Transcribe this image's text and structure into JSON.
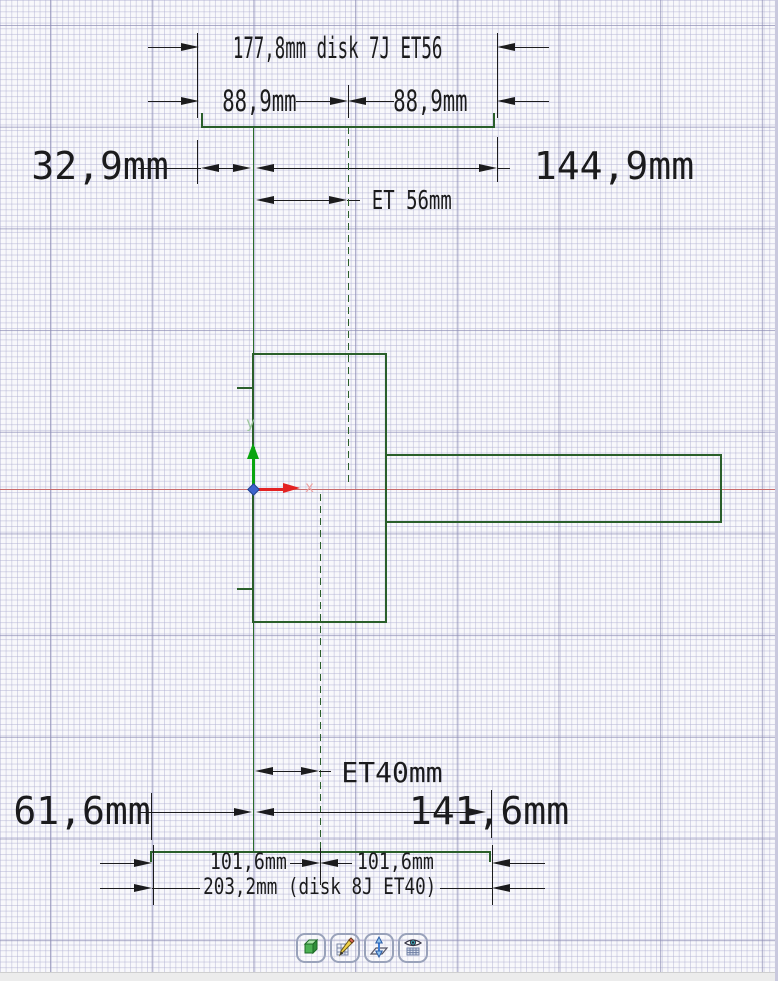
{
  "app": {
    "name": "CAD wheel drawing canvas"
  },
  "dimensions": {
    "top_disk": {
      "width": "177,8mm disk 7J ET56",
      "half_left": "88,9mm",
      "half_right": "88,9mm",
      "back_space": "32,9mm",
      "front_space": "144,9mm",
      "offset": "ET 56mm"
    },
    "bottom_disk": {
      "offset": "ET40mm",
      "back_space": "61,6mm",
      "front_space": "141,6mm",
      "half_left": "101,6mm",
      "half_right": "101,6mm",
      "width": "203,2mm (disk 8J ET40)"
    }
  },
  "axes": {
    "x": "x",
    "y": "y"
  },
  "toolbar": {
    "buttons": [
      {
        "icon": "cube-icon"
      },
      {
        "icon": "sketch-pencil-icon"
      },
      {
        "icon": "plane-normal-icon"
      },
      {
        "icon": "eye-table-icon"
      }
    ]
  },
  "colors": {
    "geometry_green": "#2a5f2a",
    "axis_green": "#0aa50f",
    "axis_red": "#e32222",
    "datum_red": "#c96a6a",
    "origin_blue": "#3e63cc",
    "dim_ink": "#1b1b1d",
    "grid_minor": "#b0b0d2",
    "grid_major": "#8c8cb4"
  }
}
